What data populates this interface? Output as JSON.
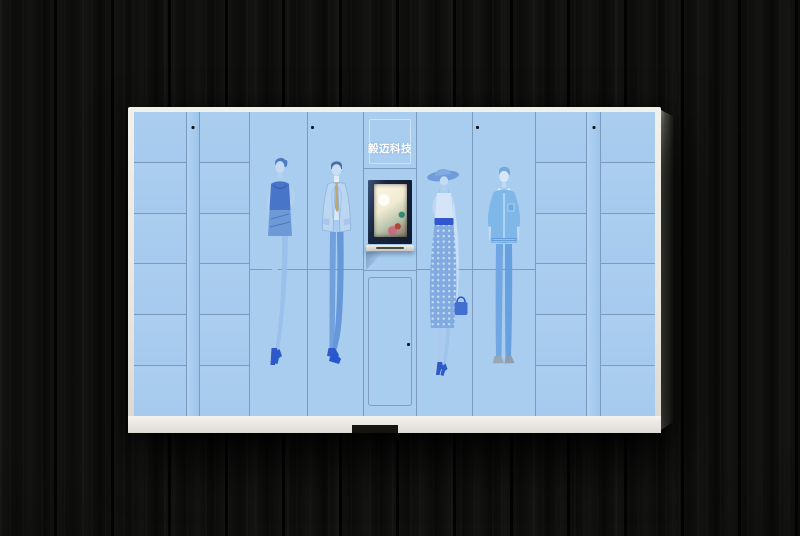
{
  "scene": {
    "type": "product-photo",
    "subject": "smart clothing locker cabinet mounted on dark wood plank wall"
  },
  "cabinet": {
    "brand_label": "毅迈科技",
    "left_lockers": {
      "columns": 2,
      "rows_per_column": 6
    },
    "right_lockers": {
      "columns": 2,
      "rows_per_column": 6
    },
    "display_door_prints": [
      "woman-sketch",
      "suit-man",
      "hat-woman",
      "casual-man"
    ],
    "console": {
      "parts": [
        "brand panel",
        "touch screen",
        "card slot ledge",
        "service door"
      ]
    },
    "colors": {
      "door_blue": "#a9cdef",
      "grid_line": "#5f7aa0",
      "frame_white": "#eceae5",
      "print_blue": "#5d88c8",
      "print_dark_blue": "#3c68c2",
      "accent_royal": "#2b50cc",
      "tie_tan": "#c0a468",
      "screen_bezel": "#17263f",
      "wood_wall": "#0e0e0d"
    }
  }
}
